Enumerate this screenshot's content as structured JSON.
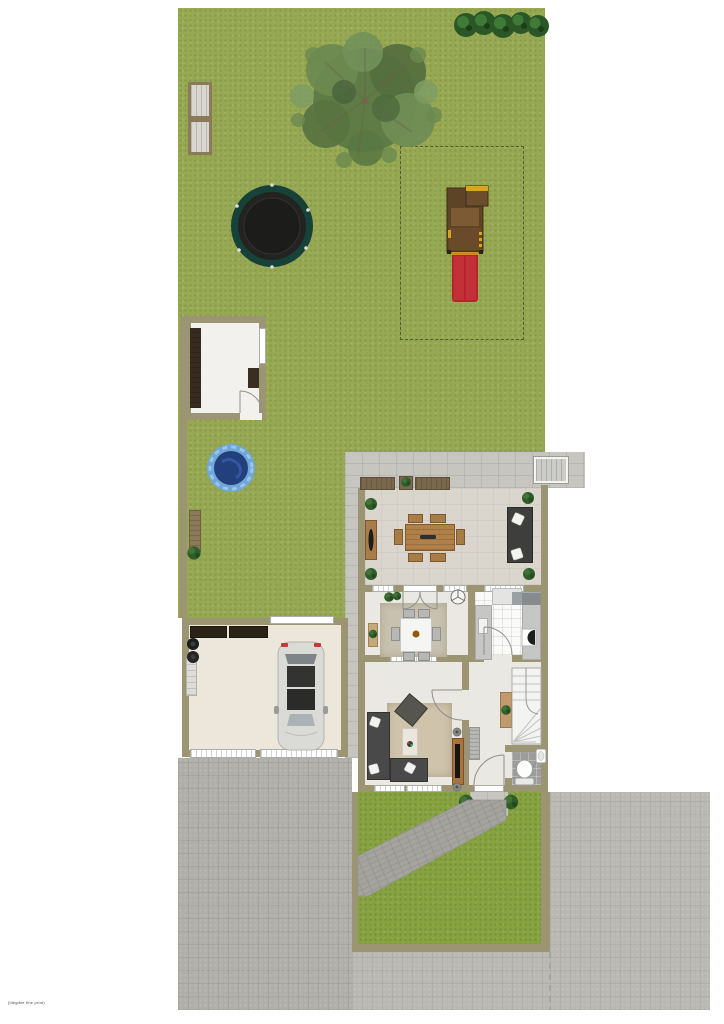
{
  "watermark": "(illegible fine print)",
  "palette": {
    "background": "#ffffff",
    "grass_back": "#97a853",
    "grass_front": "#86a241",
    "wall": "#9c9573",
    "paving_driveway": "#b1afa9",
    "paving_slab": "#c7c5c0",
    "terrace_floor": "#dad6cd",
    "house_floor": "#eae8e3",
    "garage_floor": "#ece7da",
    "shed_floor": "#f2f1ee",
    "kitchen_tile": "#fafaf8",
    "bathroom_tile": "#9d9d9b",
    "pool_ring": "#6fa7d8",
    "pool_water": "#24407c",
    "trampoline_ring": "#16423a",
    "trampoline_mat": "#232321",
    "slide_red": "#b6242c",
    "playset_wood": "#5e4426",
    "accent_yellow": "#d9a520",
    "sofa_dark": "#49494a",
    "wood_furniture": "#b08048",
    "tree_foliage": "#5f7c46",
    "hedge_green": "#2b5726"
  },
  "objects": {
    "back_garden": "Back garden lawn",
    "hedge_row": "Row of five hedge bushes",
    "tree": "Large garden tree",
    "double_bench": "Pair of garden benches",
    "trampoline": "Round trampoline",
    "play_area": "Play area marked with dashed outline",
    "play_structure": "Wooden climbing frame with red slide",
    "shed": "Garden shed with shelving",
    "pool": "Small round kiddie pool",
    "pool_bench": "Small wooden bench",
    "terrace": "Covered terrace: benches, sideboard, dining table with six chairs, lounge sofa, potted plants",
    "storage_box": "Storage box on back pavement",
    "house": "Ground floor: dining room, kitchen, living room, hall with winder stairs, WC",
    "dining_room": "Dining room with table, six chairs, rug, plant, ceiling fan",
    "kitchen": "Kitchen with counters, fridge, oven, sink",
    "living_room": "Living room with corner sofa, coffee table, rug, TV cabinet, speakers",
    "hall": "Hall with console table, radiator, winder staircase, front door",
    "bathroom": "WC with toilet and hand basin",
    "garage": "Garage with parked car, cabinets, shelf, bins, two garage doors",
    "driveway": "Block-paved driveway",
    "front_garden": "Front garden with diagonal brick path and two bushes",
    "street": "Public pavement / street area"
  }
}
